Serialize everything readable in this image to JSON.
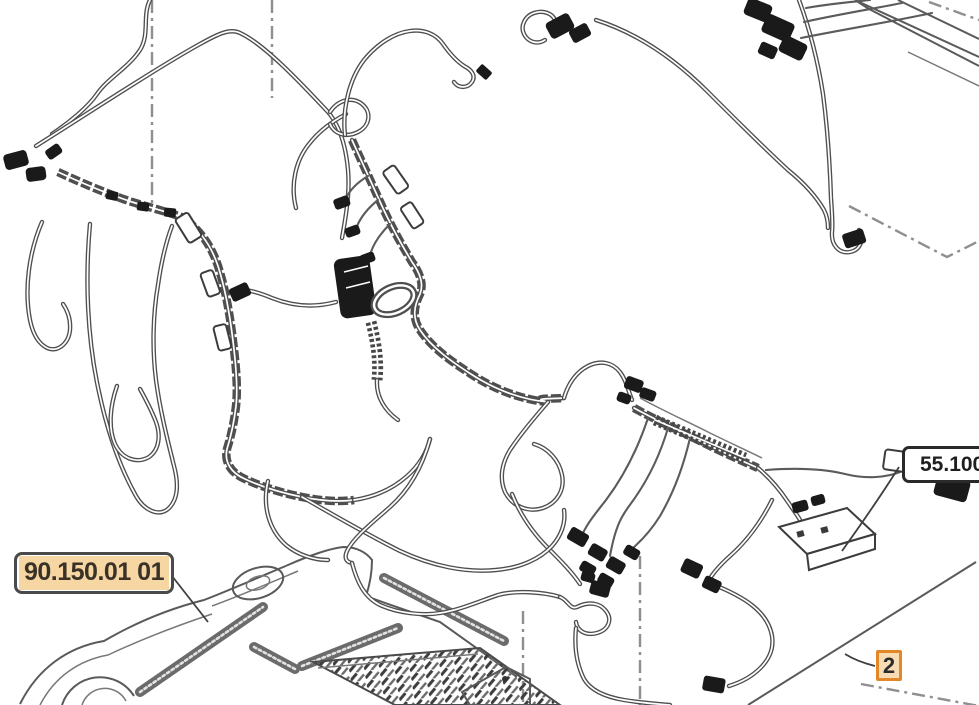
{
  "diagram": {
    "part_reference_boxes": [
      {
        "text": "90.150.01 01",
        "highlighted": true
      },
      {
        "text": "55.100",
        "highlighted": false
      }
    ],
    "callouts": [
      {
        "text": "2"
      }
    ],
    "colors": {
      "highlight_fill": "#f6d6a2",
      "callout_border": "#e2882b",
      "callout_fill": "#f7dcb4",
      "line_color": "#4f4f4f",
      "reference_line_color": "#8f8f8f"
    }
  }
}
